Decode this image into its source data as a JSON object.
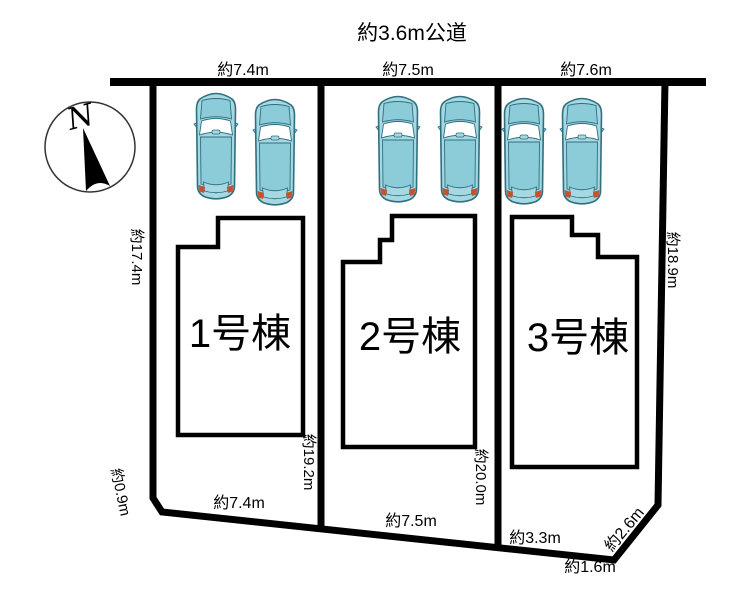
{
  "road": {
    "title": "約3.6m公道"
  },
  "compass": {
    "north_label": "N"
  },
  "dimensions": {
    "top_widths": [
      "約7.4m",
      "約7.5m",
      "約7.6m"
    ],
    "left_side": "約17.4m",
    "left_corner": "約0.9m",
    "right_side": "約18.9m",
    "inner_depth_lot1": "約19.2m",
    "inner_depth_lot2": "約20.0m",
    "bottom_lot1": "約7.4m",
    "bottom_lot2": "約7.5m",
    "bottom_lot3": "約3.3m",
    "bottom_corner": "約1.6m",
    "bottom_diagonal": "約2.6m"
  },
  "lots": [
    {
      "house_label": "1号棟"
    },
    {
      "house_label": "2号棟"
    },
    {
      "house_label": "3号棟"
    }
  ],
  "colors": {
    "line": "#000000",
    "car_body": "#a5d8e1",
    "car_cabin": "#8ccbd8",
    "car_outline": "#2e6f80",
    "car_glass": "#ffffff",
    "taillight": "#c9502e"
  }
}
